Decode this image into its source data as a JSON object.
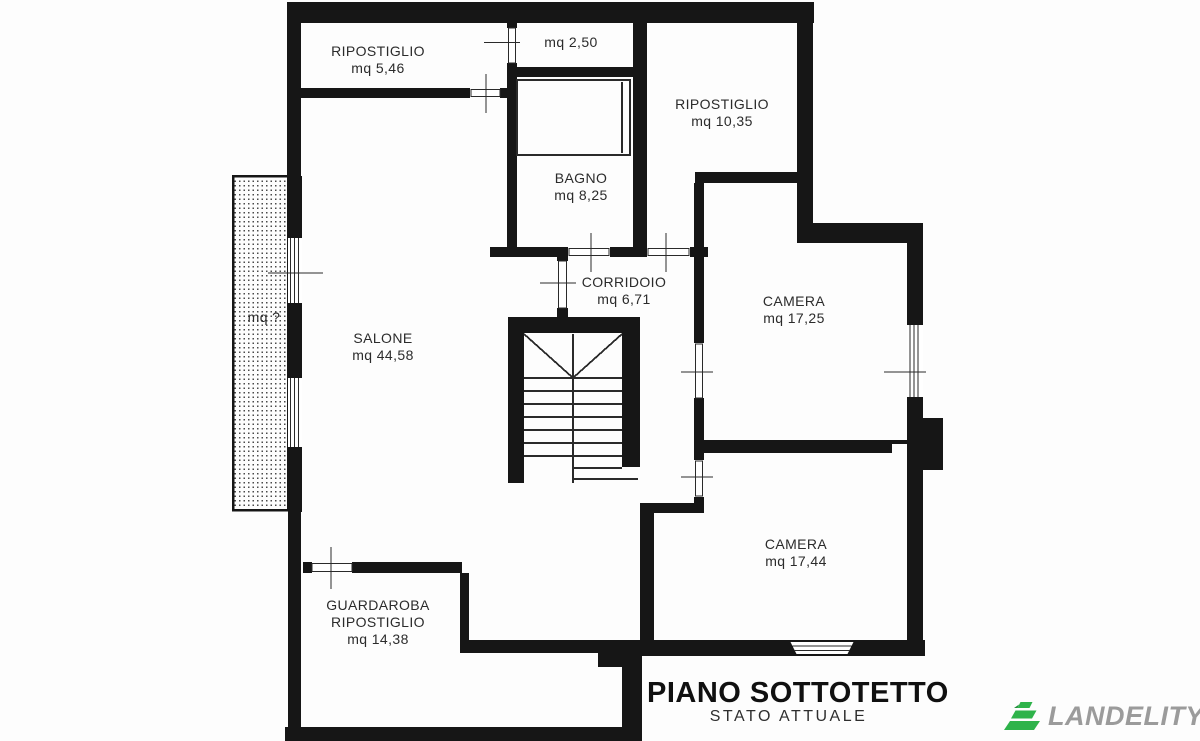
{
  "plan": {
    "rooms": {
      "ripostiglio_nw": {
        "label": "RIPOSTIGLIO",
        "area": "mq 5,46"
      },
      "vano_piccolo": {
        "area": "mq 2,50"
      },
      "ripostiglio_ne": {
        "label": "RIPOSTIGLIO",
        "area": "mq 10,35"
      },
      "bagno": {
        "label": "BAGNO",
        "area": "mq 8,25"
      },
      "corridoio": {
        "label": "CORRIDOIO",
        "area": "mq 6,71"
      },
      "camera_est": {
        "label": "CAMERA",
        "area": "mq 17,25"
      },
      "salone": {
        "label": "SALONE",
        "area": "mq 44,58"
      },
      "camera_sud": {
        "label": "CAMERA",
        "area": "mq 17,44"
      },
      "guardaroba": {
        "label": "GUARDAROBA",
        "label2": "RIPOSTIGLIO",
        "area": "mq 14,38"
      },
      "terrazza": {
        "area": "mq ?"
      }
    }
  },
  "title_block": {
    "title": "PIANO SOTTOTETTO",
    "subtitle": "STATO ATTUALE"
  },
  "logo": {
    "brand": "LANDELITY"
  },
  "colors": {
    "ink": "#161616",
    "logo_green": "#2eb34a",
    "logo_green_dark": "#1f8f3a",
    "logo_gray": "#9b9b9b"
  }
}
